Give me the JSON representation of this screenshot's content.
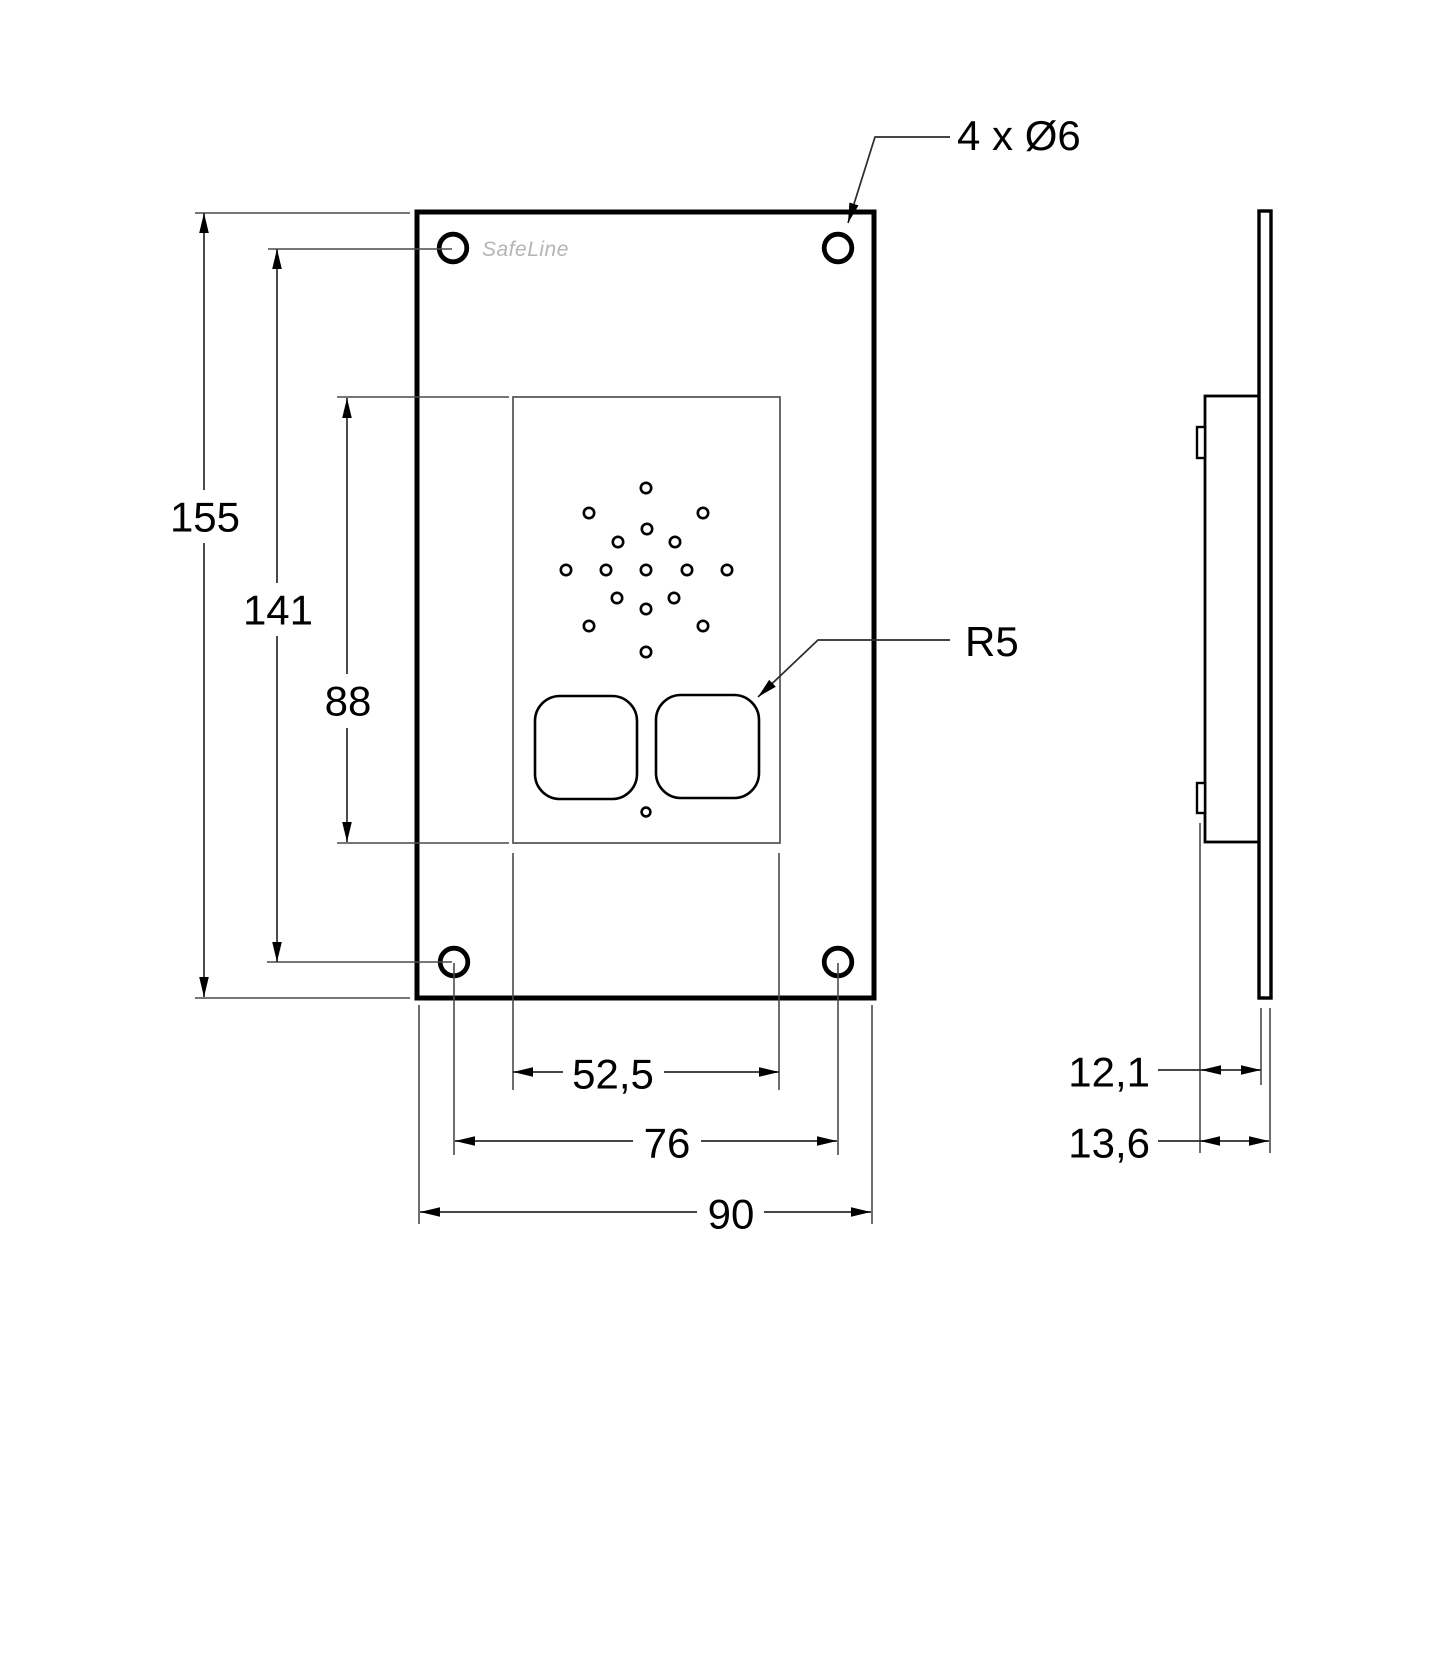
{
  "logo": "SafeLine",
  "callouts": {
    "mounting_holes": "4 x Ø6",
    "corner_radius": "R5"
  },
  "dims": {
    "overall_height": "155",
    "hole_pitch_vertical": "141",
    "cutout_height": "88",
    "cutout_width": "52,5",
    "hole_pitch_horizontal": "76",
    "overall_width": "90",
    "depth_box": "12,1",
    "depth_overall": "13,6"
  }
}
